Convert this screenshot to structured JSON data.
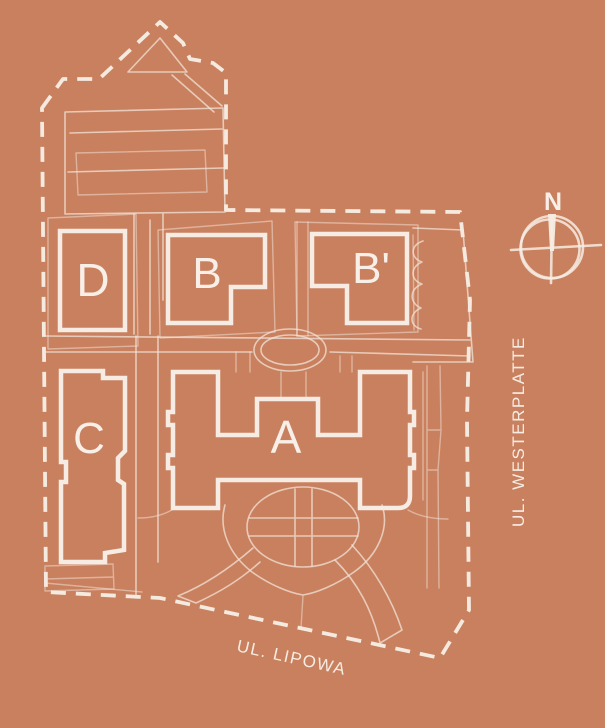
{
  "map": {
    "background_color": "#c9805f",
    "outline_color": "#f7ece3",
    "highlight_color": "#ae431b",
    "buildings": [
      {
        "id": "A",
        "label": "A",
        "highlighted": false
      },
      {
        "id": "B",
        "label": "B",
        "highlighted": true
      },
      {
        "id": "B-prime",
        "label": "B'",
        "highlighted": false
      },
      {
        "id": "C",
        "label": "C",
        "highlighted": false
      },
      {
        "id": "D",
        "label": "D",
        "highlighted": false
      }
    ],
    "streets": [
      {
        "name": "UL. WESTERPLATTE"
      },
      {
        "name": "UL. LIPOWA"
      }
    ],
    "compass": {
      "label": "N"
    }
  }
}
